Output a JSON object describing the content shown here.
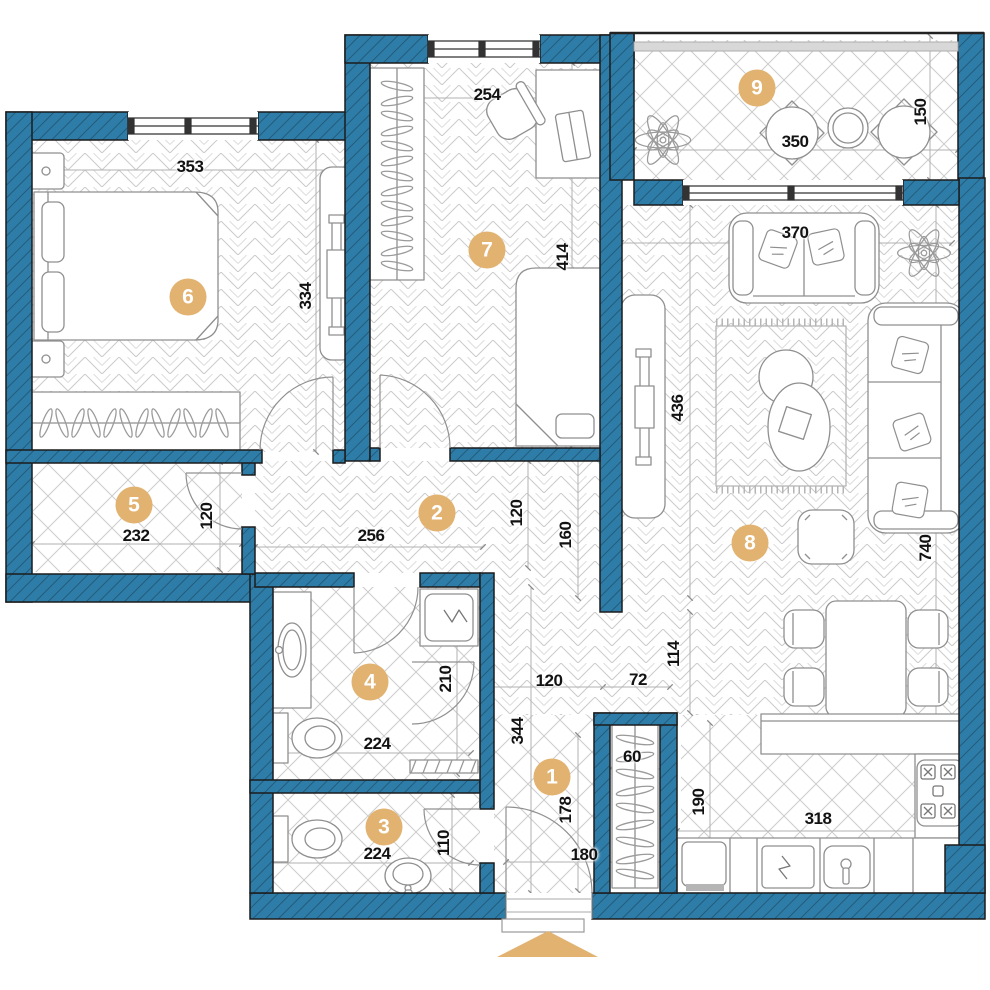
{
  "title": "Apartment floor plan",
  "colors": {
    "wall_fill": "#2e7da9",
    "wall_hatch": "#1b4a63",
    "accent": "#e2b271",
    "floor_line": "#cbcbcb",
    "dim_text": "#121212"
  },
  "rooms": [
    {
      "number": "1"
    },
    {
      "number": "2"
    },
    {
      "number": "3"
    },
    {
      "number": "4"
    },
    {
      "number": "5"
    },
    {
      "number": "6"
    },
    {
      "number": "7"
    },
    {
      "number": "8"
    },
    {
      "number": "9"
    }
  ],
  "dims": {
    "room6_w": "353",
    "room6_h": "334",
    "room7_w": "254",
    "room7_h": "414",
    "balcony_w": "350",
    "balcony_d": "150",
    "living_w": "370",
    "living_h1": "436",
    "living_h2": "740",
    "room5_w": "232",
    "room5_door": "120",
    "hall_w": "256",
    "hall_d": "120",
    "hall_open": "160",
    "shower_h": "210",
    "bath_w": "224",
    "bath_door": "120",
    "pass_w": "72",
    "pass_h": "114",
    "wc_w": "224",
    "wc_d": "110",
    "entry_l": "344",
    "entry_w": "178",
    "door_w": "180",
    "closet_w": "60",
    "kitchen_d": "190",
    "kitchen_w": "318"
  }
}
